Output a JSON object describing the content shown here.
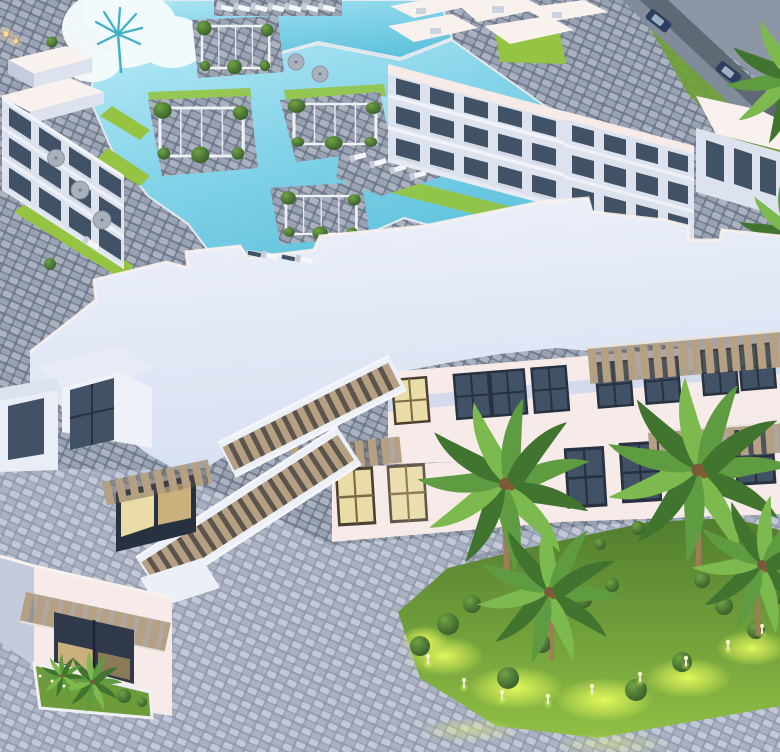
{
  "meta": {
    "alt": "Aerial dusk 3D architectural rendering of a seaside resort: turquoise lagoon pools with vine-covered pergolas and sun loungers, white three-storey apartment blocks, a large white clubhouse with twin grand staircases, cobblestone plazas and an illuminated palm garden",
    "render_type": "3d-architectural-aerial-render",
    "time_of_day": "dusk"
  },
  "scene": {
    "areas": [
      {
        "name": "lagoon-pool",
        "description": "irregular turquoise swimming lagoon with cloud and palm reflection"
      },
      {
        "name": "upper-pool",
        "description": "upper pool strip with lounger deck"
      },
      {
        "name": "pergolas",
        "count": 4,
        "description": "white lattice pergolas with climbing greenery on pool decks"
      },
      {
        "name": "apartments-west",
        "floors": 3,
        "description": "white apartment terrace block with dark glass balconies, patio umbrellas and hedges"
      },
      {
        "name": "apartments-north",
        "floors": 3,
        "description": "white apartment blocks with roof hatches and balcony rows"
      },
      {
        "name": "access-road",
        "description": "diagonal perimeter road on stone embankment with two cars"
      },
      {
        "name": "clubhouse",
        "description": "large white clubhouse with pale flat roof, glazed facades, slatted pergola canopies and two diagonal grand staircases"
      },
      {
        "name": "storefront-annex",
        "description": "corner annex with slatted canopy, warm lit glazing and planter bed"
      },
      {
        "name": "palm-garden",
        "description": "landscaped island with palm trees, topiary bushes and glowing bollard lights"
      },
      {
        "name": "plaza",
        "description": "cobblestone pedestrian plaza"
      }
    ],
    "counts": {
      "pergolas": 4,
      "garden_palms": 4,
      "roadside_palms": 2,
      "topiary_bushes": 15,
      "garden_lights": 9,
      "cars": 2,
      "staircases": 2,
      "patio_umbrellas": 5
    }
  },
  "palette": {
    "paving_base": "#8791a2",
    "paving_stone_a": "#aab2c0",
    "paving_stone_b": "#99a2b2",
    "paving_joint": "#717a8b",
    "plaza_base": "#939cae",
    "plaza_stone_a": "#c2c8d5",
    "plaza_stone_b": "#aab2c2",
    "pool": "#85d4e9",
    "pool_deep": "#5fc2dd",
    "pool_light": "#b5e9f5",
    "pool_edge": "#e3e9f0",
    "cloud": "#f5fcfd",
    "cloud_palm": "#3fb0c9",
    "lawn": "#94c441",
    "lawn_dark": "#6fa035",
    "grass_top": "#527d2f",
    "grass_mid": "#8fbf45",
    "glow": "#ecff5e",
    "facade_lit": "#f6ebe8",
    "facade_shadow": "#dde3ee",
    "facade_deep": "#c3cbdc",
    "roof_a": "#edf1fa",
    "roof_b": "#d8e1f2",
    "parapet": "#f8f1ee",
    "band_blue": "#c9d6ec",
    "glass_dark": "#415266",
    "glass_frame": "#27313f",
    "glass_lit": "#eadca6",
    "glass_lit_dim": "#c9b07c",
    "slat": "#b5a084",
    "slat_dark": "#5c544a",
    "stair_wall": "#eceff6",
    "road": "#5f6875",
    "wall_stone": "#828b99",
    "ground": "#8c96a4",
    "car_body": "#2d3f5e",
    "car_glass": "#9db1c6",
    "trunk": "#a07c59",
    "frond": "#5f9c41",
    "frond_dark": "#41742f",
    "frond_light": "#7cb94e",
    "bush_hi": "#6fa344",
    "bush_lo": "#35582a",
    "white": "#f4f6f9",
    "umbrella": "#a9b1bd"
  }
}
